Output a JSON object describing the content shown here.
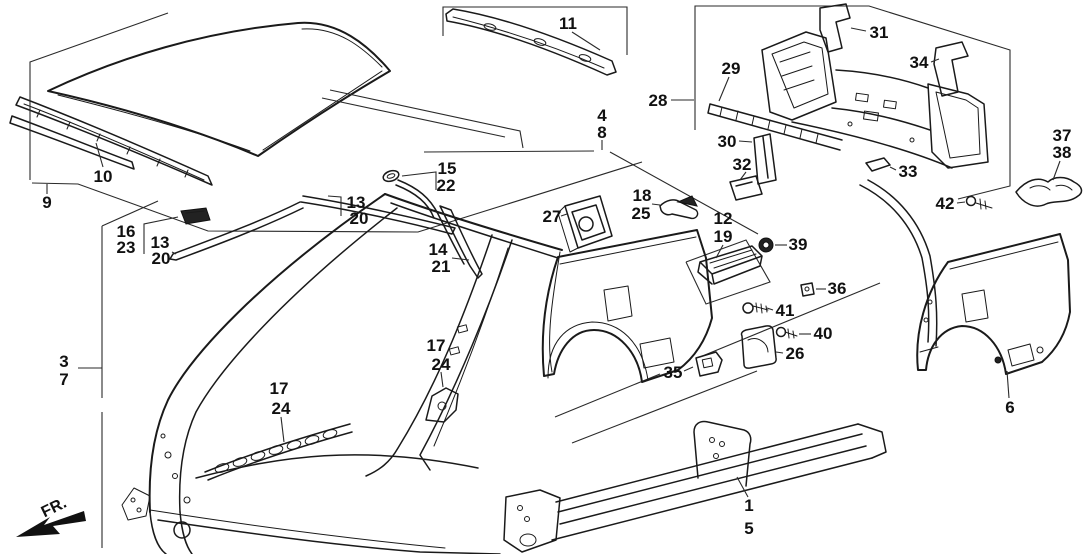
{
  "diagram": {
    "type": "exploded-parts-diagram",
    "subject": "car body outer panels side/roof/rear section",
    "background": "#ffffff",
    "line_color": "#1a1a1a",
    "label_color": "#111111",
    "fr_indicator": {
      "label": "FR."
    },
    "callouts": [
      {
        "part": "roof-side-group",
        "labels": [
          {
            "t": "9",
            "x": 47,
            "y": 202
          }
        ],
        "leader": [
          [
            47,
            194
          ],
          [
            47,
            184
          ]
        ]
      },
      {
        "part": "front-roof-rail",
        "labels": [
          {
            "t": "10",
            "x": 103,
            "y": 176
          }
        ],
        "leader": [
          [
            103,
            167
          ],
          [
            96,
            143
          ]
        ]
      },
      {
        "part": "rear-roof-rail",
        "labels": [
          {
            "t": "11",
            "x": 568,
            "y": 23
          }
        ],
        "leader": [
          [
            572,
            32
          ],
          [
            600,
            50
          ]
        ]
      },
      {
        "part": "outer-panel-group",
        "labels": [
          {
            "t": "4",
            "x": 602,
            "y": 115
          },
          {
            "t": "8",
            "x": 602,
            "y": 132
          }
        ],
        "leader": [
          [
            602,
            140
          ],
          [
            602,
            150
          ]
        ]
      },
      {
        "part": "rear-panel-group",
        "labels": [
          {
            "t": "28",
            "x": 658,
            "y": 100
          }
        ],
        "leader": [
          [
            671,
            100
          ],
          [
            694,
            100
          ]
        ]
      },
      {
        "part": "rear-crossmember",
        "labels": [
          {
            "t": "29",
            "x": 731,
            "y": 68
          }
        ],
        "leader": [
          [
            729,
            77
          ],
          [
            719,
            101
          ]
        ]
      },
      {
        "part": "crossmember-channel",
        "labels": [
          {
            "t": "30",
            "x": 727,
            "y": 141
          }
        ],
        "leader": [
          [
            739,
            141
          ],
          [
            752,
            142
          ]
        ]
      },
      {
        "part": "rear-bracket-left",
        "labels": [
          {
            "t": "31",
            "x": 879,
            "y": 32
          }
        ],
        "leader": [
          [
            866,
            31
          ],
          [
            851,
            28
          ]
        ]
      },
      {
        "part": "crossmember-foot",
        "labels": [
          {
            "t": "32",
            "x": 742,
            "y": 164
          }
        ],
        "leader": [
          [
            746,
            172
          ],
          [
            740,
            180
          ]
        ]
      },
      {
        "part": "rear-panel-clip",
        "labels": [
          {
            "t": "33",
            "x": 908,
            "y": 171
          }
        ],
        "leader": [
          [
            896,
            170
          ],
          [
            890,
            167
          ]
        ]
      },
      {
        "part": "rear-bracket-right",
        "labels": [
          {
            "t": "34",
            "x": 919,
            "y": 62
          }
        ],
        "leader": [
          [
            931,
            62
          ],
          [
            939,
            59
          ]
        ]
      },
      {
        "part": "gutter-bracket",
        "labels": [
          {
            "t": "37",
            "x": 1062,
            "y": 135
          },
          {
            "t": "38",
            "x": 1062,
            "y": 152
          }
        ],
        "leader": [
          [
            1060,
            161
          ],
          [
            1053,
            180
          ]
        ]
      },
      {
        "part": "bolt-42",
        "labels": [
          {
            "t": "42",
            "x": 945,
            "y": 203
          }
        ],
        "leader": [
          [
            957,
            203
          ],
          [
            965,
            202
          ]
        ]
      },
      {
        "part": "molding-clip",
        "labels": [
          {
            "t": "16",
            "x": 126,
            "y": 231
          },
          {
            "t": "23",
            "x": 126,
            "y": 247
          }
        ],
        "leader": [
          [
            144,
            254
          ],
          [
            144,
            224
          ],
          [
            178,
            217
          ]
        ]
      },
      {
        "part": "roof-molding-front",
        "labels": [
          {
            "t": "13",
            "x": 160,
            "y": 242
          },
          {
            "t": "20",
            "x": 161,
            "y": 258
          }
        ],
        "leader": [
          [
            172,
            252
          ],
          [
            176,
            254
          ]
        ]
      },
      {
        "part": "roof-molding-rear",
        "labels": [
          {
            "t": "13",
            "x": 356,
            "y": 202
          },
          {
            "t": "20",
            "x": 359,
            "y": 218
          }
        ],
        "leader": [
          [
            341,
            216
          ],
          [
            341,
            197
          ],
          [
            328,
            196
          ]
        ]
      },
      {
        "part": "drip-molding-upper",
        "labels": [
          {
            "t": "15",
            "x": 447,
            "y": 168
          },
          {
            "t": "22",
            "x": 446,
            "y": 185
          }
        ],
        "leader": [
          [
            436,
            190
          ],
          [
            436,
            172
          ],
          [
            402,
            176
          ]
        ]
      },
      {
        "part": "drip-molding-lower",
        "labels": [
          {
            "t": "14",
            "x": 438,
            "y": 249
          },
          {
            "t": "21",
            "x": 441,
            "y": 266
          }
        ],
        "leader": [
          [
            452,
            258
          ],
          [
            469,
            260
          ]
        ]
      },
      {
        "part": "fuel-filler-pocket",
        "labels": [
          {
            "t": "27",
            "x": 552,
            "y": 216
          }
        ],
        "leader": [
          [
            561,
            216
          ],
          [
            567,
            214
          ]
        ]
      },
      {
        "part": "clip-18-25",
        "labels": [
          {
            "t": "18",
            "x": 642,
            "y": 195
          },
          {
            "t": "25",
            "x": 641,
            "y": 213
          }
        ],
        "leader": [
          [
            652,
            204
          ],
          [
            660,
            205
          ]
        ]
      },
      {
        "part": "sill-garnish",
        "labels": [
          {
            "t": "12",
            "x": 723,
            "y": 218
          },
          {
            "t": "19",
            "x": 723,
            "y": 236
          }
        ],
        "leader": [
          [
            723,
            245
          ],
          [
            716,
            258
          ]
        ]
      },
      {
        "part": "grommet-39",
        "labels": [
          {
            "t": "39",
            "x": 798,
            "y": 244
          }
        ],
        "leader": [
          [
            787,
            245
          ],
          [
            775,
            245
          ]
        ]
      },
      {
        "part": "nut-36",
        "labels": [
          {
            "t": "36",
            "x": 837,
            "y": 288
          }
        ],
        "leader": [
          [
            826,
            289
          ],
          [
            816,
            289
          ]
        ]
      },
      {
        "part": "bolt-41",
        "labels": [
          {
            "t": "41",
            "x": 785,
            "y": 310
          }
        ],
        "leader": [
          [
            773,
            310
          ],
          [
            767,
            308
          ]
        ]
      },
      {
        "part": "bolt-40",
        "labels": [
          {
            "t": "40",
            "x": 823,
            "y": 333
          }
        ],
        "leader": [
          [
            811,
            334
          ],
          [
            799,
            334
          ]
        ]
      },
      {
        "part": "fuel-filler-lid",
        "labels": [
          {
            "t": "26",
            "x": 795,
            "y": 353
          }
        ],
        "leader": [
          [
            783,
            353
          ],
          [
            776,
            352
          ]
        ]
      },
      {
        "part": "lock-bracket-35",
        "labels": [
          {
            "t": "35",
            "x": 673,
            "y": 372
          }
        ],
        "leader": [
          [
            684,
            371
          ],
          [
            693,
            367
          ]
        ]
      },
      {
        "part": "side-panel-group",
        "labels": [
          {
            "t": "3",
            "x": 64,
            "y": 361
          },
          {
            "t": "7",
            "x": 64,
            "y": 379
          }
        ],
        "leader": [
          [
            78,
            368
          ],
          [
            102,
            368
          ]
        ]
      },
      {
        "part": "sill-stiffener",
        "labels": [
          {
            "t": "17",
            "x": 279,
            "y": 388
          },
          {
            "t": "24",
            "x": 281,
            "y": 408
          }
        ],
        "leader": [
          [
            281,
            417
          ],
          [
            284,
            442
          ]
        ]
      },
      {
        "part": "pillar-bracket",
        "labels": [
          {
            "t": "17",
            "x": 436,
            "y": 345
          },
          {
            "t": "24",
            "x": 441,
            "y": 364
          }
        ],
        "leader": [
          [
            441,
            372
          ],
          [
            443,
            387
          ]
        ]
      },
      {
        "part": "rocker-sill",
        "labels": [
          {
            "t": "1",
            "x": 749,
            "y": 505
          },
          {
            "t": "5",
            "x": 749,
            "y": 528
          }
        ],
        "leader": [
          [
            748,
            497
          ],
          [
            737,
            477
          ]
        ]
      },
      {
        "part": "quarter-extension",
        "labels": [
          {
            "t": "6",
            "x": 1010,
            "y": 407
          }
        ],
        "leader": [
          [
            1009,
            398
          ],
          [
            1007,
            371
          ]
        ]
      }
    ]
  }
}
